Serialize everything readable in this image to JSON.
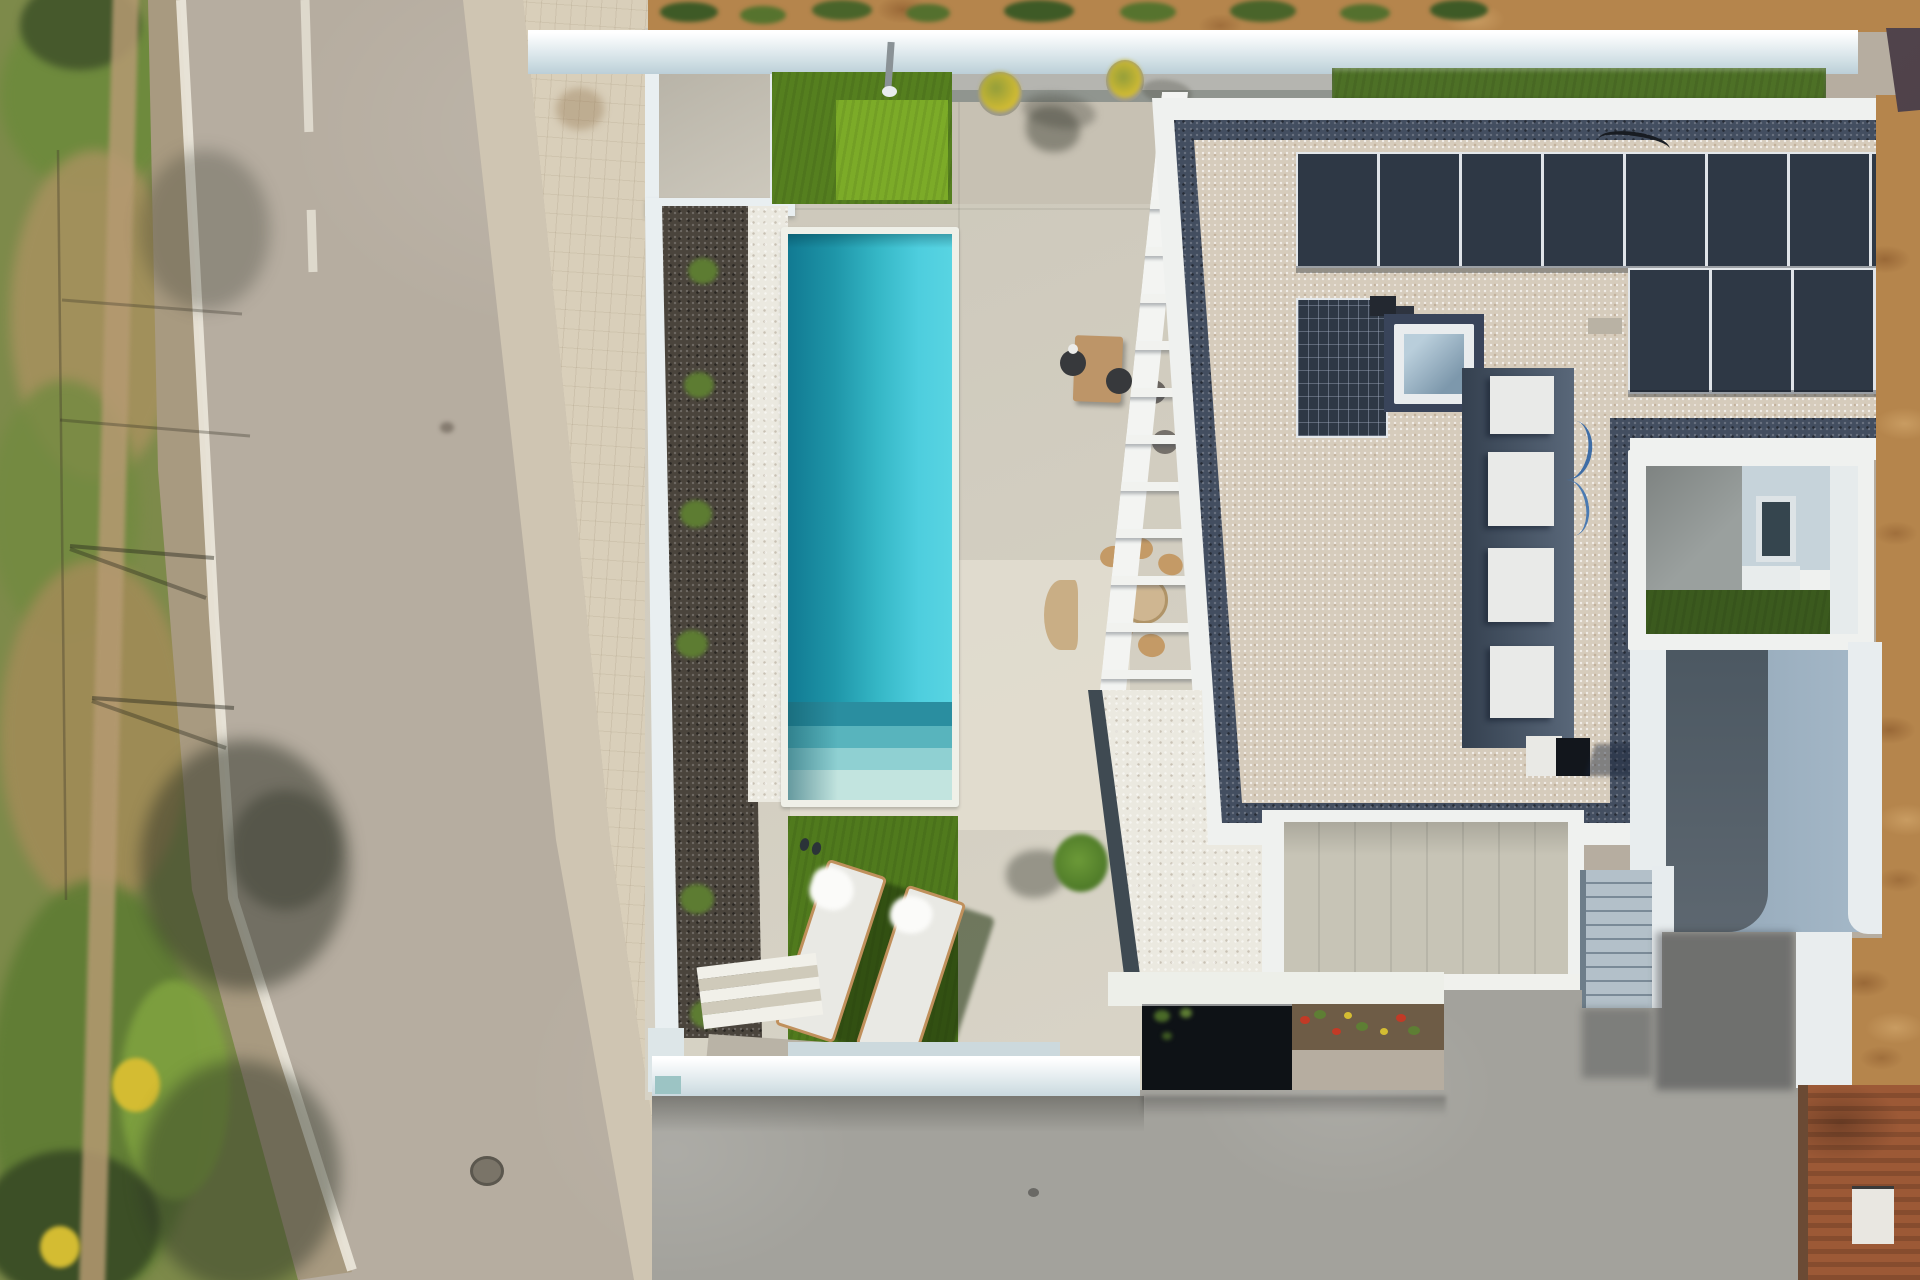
{
  "scene": {
    "type": "aerial-drone-photo",
    "subject": "modern white villa with rectangular turquoise pool, solar panel flat roof, artificial lawn with two sun loungers, asphalt road on the left",
    "view": "top-down",
    "lighting": "bright midday sun, shadows cast to the right"
  },
  "palette": {
    "road": "#b6ada0",
    "road_marking": "#ece8dc",
    "shoulder": "#a89a80",
    "vegetation": "#7d8a4a",
    "vegetation_dry": "#a8925f",
    "vegetation_dark": "#46592c",
    "dirt_trail": "#b59a72",
    "flower_yellow": "#d4bc32",
    "sidewalk": "#cfc5b2",
    "pavers": "#d9cfba",
    "wall": "#e9eff1",
    "wall_shaded": "#cfdde2",
    "deck": "#d6d1c3",
    "deck_bright": "#e4dfd1",
    "deck_shaded": "#c7c1b3",
    "entrance_pad": "#c8c3b6",
    "gravel_dark": "#4a443c",
    "gravel_white": "#ebe9e0",
    "pool_deep": "#117a92",
    "pool_bright": "#58d4e2",
    "pool_step_1": "#2a8ea0",
    "pool_step_2": "#58b4bd",
    "pool_step_3": "#8fd0d2",
    "pool_step_4": "#c2e4df",
    "coping": "#eff0e8",
    "grass": "#557f1f",
    "grass_bright": "#7cab28",
    "grass_loungers": "#507a1d",
    "lounger": "#e9e9e4",
    "lounger_frame": "#c0905c",
    "towel": "#fbfbf9",
    "shrub": "#5d7c32",
    "pergola": "#f3f4f2",
    "table_wood": "#bd9568",
    "chair_dark": "#37393c",
    "chair_tan": "#c49a66",
    "parasol": "#c9ae85",
    "roof_border_white": "#eff1ef",
    "roof_border_dark": "#434e60",
    "roof_gravel": "#d6ccbc",
    "solar_panel": "#2e3845",
    "skylight_frame": "#e9ecee",
    "skylight_glass": "#8fa9bc",
    "skylight_surround": "#39445a",
    "ac_unit": "#e9eae8",
    "ac_strip": "#46566a",
    "cable_blue": "#3e6da6",
    "chimney_dark": "#12161c",
    "chimney_white": "#e9e9e5",
    "courtyard_pad": "#9aa09e",
    "courtyard_wall": "#c6d3da",
    "courtyard_grass": "#3b5a1e",
    "window_glass": "#35454e",
    "terrace": "#9ab0c2",
    "terrace_path": "#525d67",
    "garage_door": "#c7c4b6",
    "stairs": "#b3c0c9",
    "stair_stringer": "#e7ecee",
    "doormat": "#22272d",
    "driveway": "#a3a29c",
    "planter": "#0e1216",
    "flowerbed_soil": "#6e5c46",
    "flower_red": "#c23a26",
    "flower_green": "#5e7e34",
    "hedge": "#4d7026",
    "dirt": "#b5854c",
    "neighbor_roof": "#4f4049",
    "rust": "#9c5936",
    "utility_box": "#e9e7e1",
    "steps_light": "#f1f0e9",
    "steps_shade": "#cfcaba",
    "ramp": "#b9b3a6"
  },
  "objects": {
    "road": {
      "edge_line": true,
      "center_marking": "short white dashes near top"
    },
    "pool": {
      "shape": "rectangular",
      "steps": 4,
      "orientation": "vertical"
    },
    "sun_loungers": 2,
    "towels": 2,
    "slipper_pairs": 1,
    "flower_pots": 2,
    "shrubs_along_wall": 6,
    "pergola_slats": 11,
    "solar_array": {
      "rows": 3,
      "panels_row_top": 8,
      "panels_row_mid_right": 3,
      "panels_row_mid_left": 1
    },
    "skylights": 1,
    "ac_units": 4,
    "garden_steps": 5,
    "garage_doors": 1,
    "exterior_staircases": 1,
    "courtyards": 1,
    "outdoor_dining_sets": 2
  }
}
